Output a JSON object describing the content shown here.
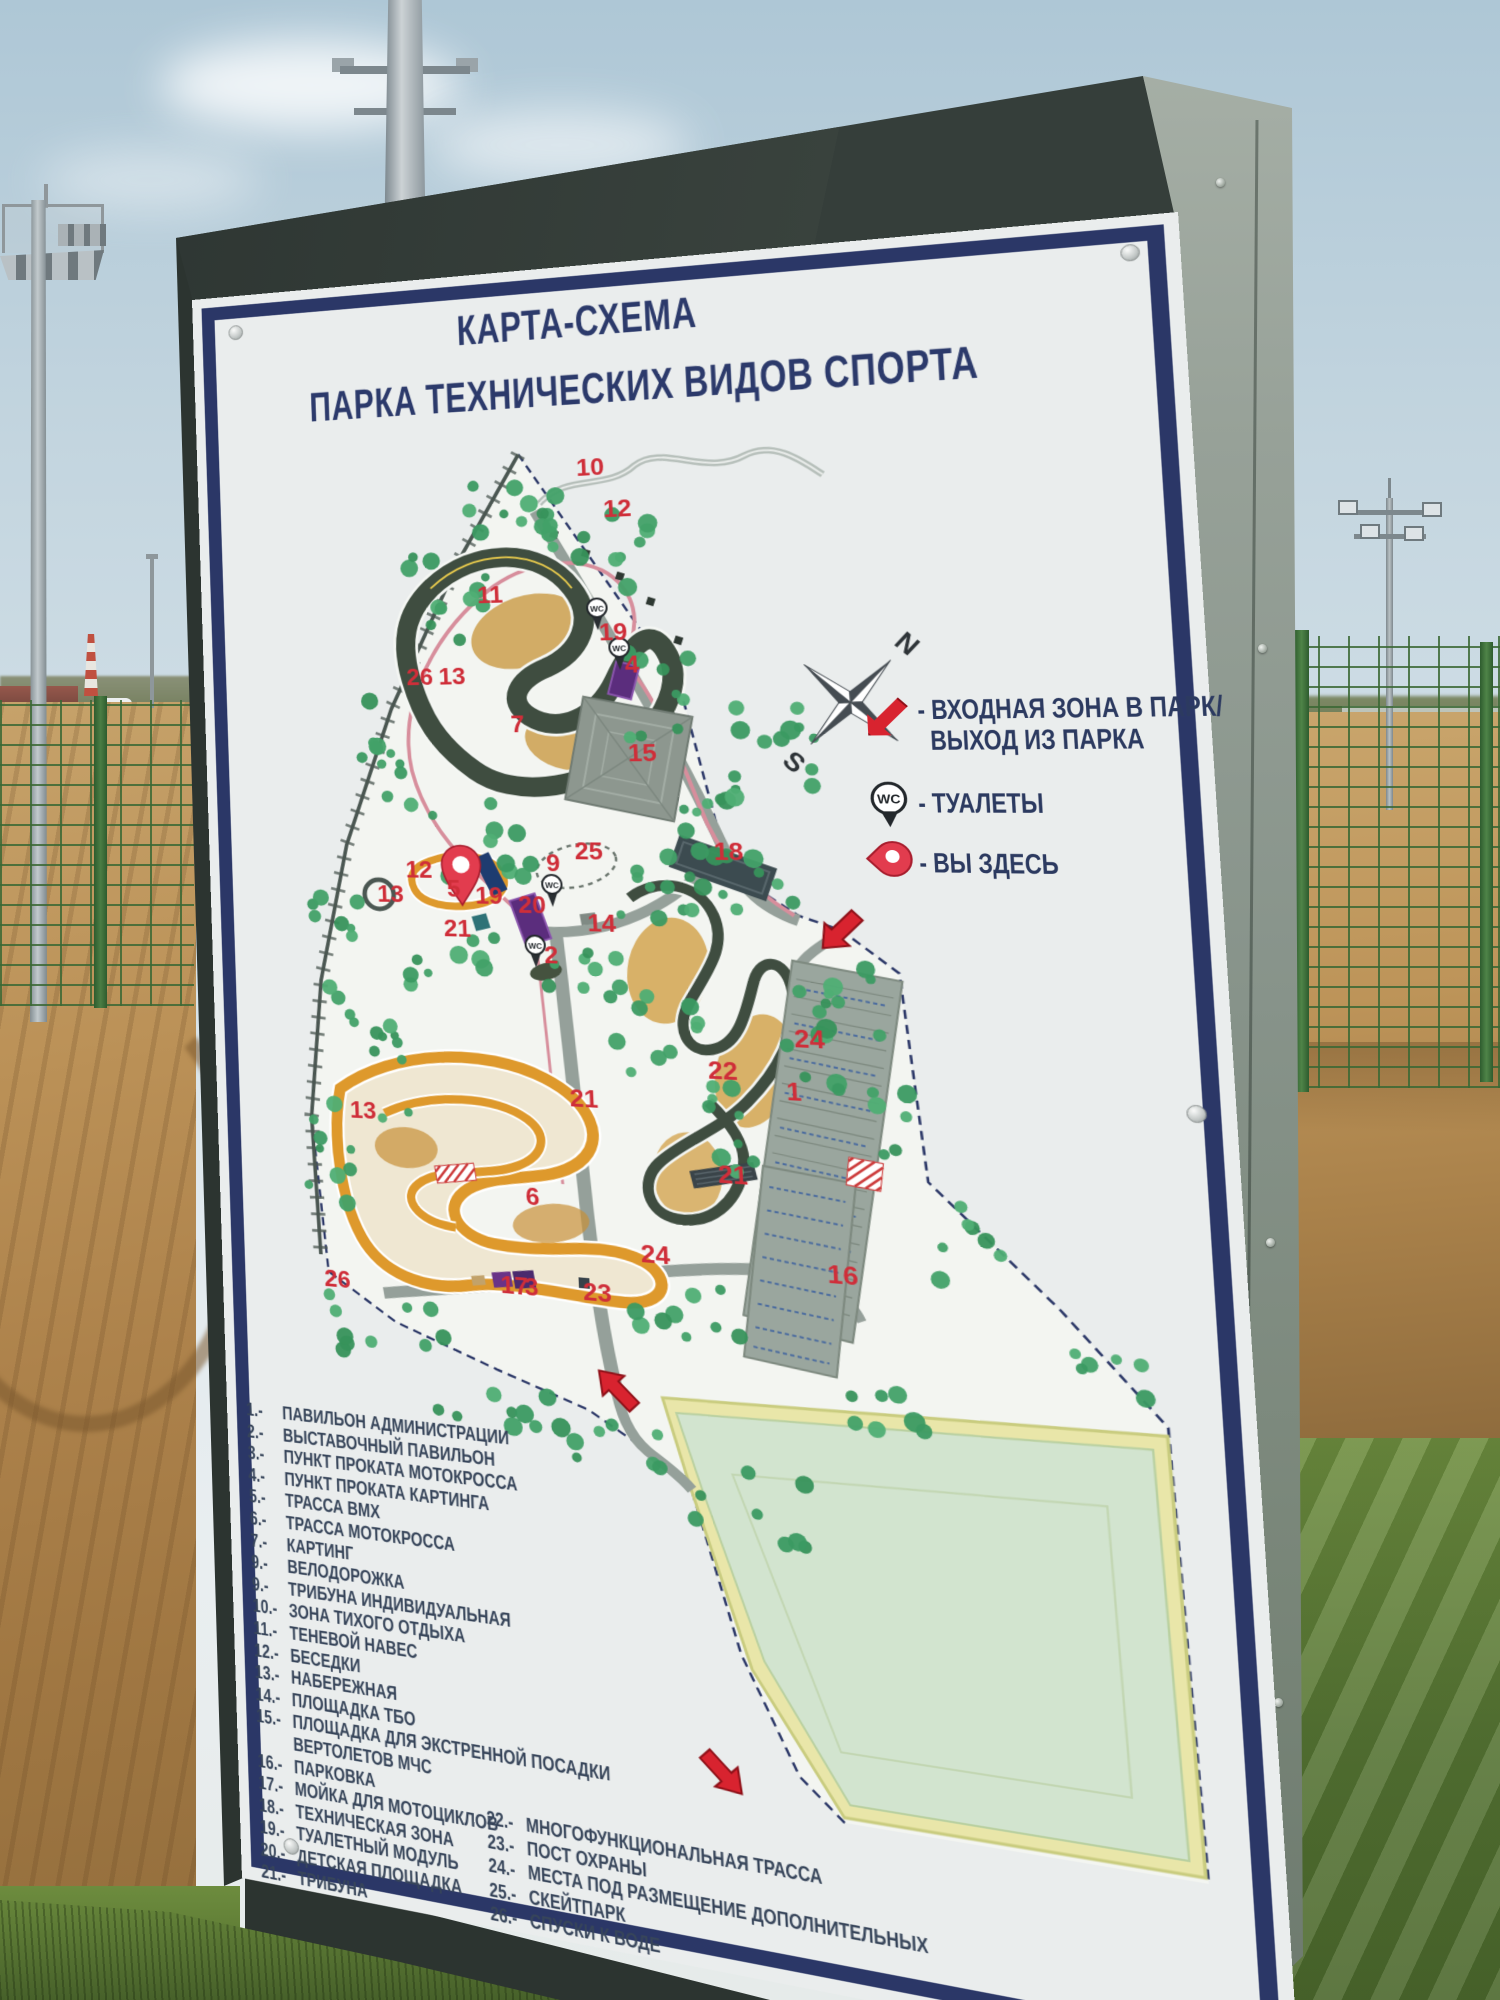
{
  "sign": {
    "title_line1": "КАРТА-СХЕМА",
    "title_line2": "ПАРКА ТЕХНИЧЕСКИХ ВИДОВ СПОРТА",
    "map_legend": {
      "entrance_line1": "- ВХОДНАЯ ЗОНА В ПАРК/",
      "entrance_line2": "ВЫХОД ИЗ ПАРКА",
      "toilets": "- ТУАЛЕТЫ",
      "you_are_here": "- ВЫ ЗДЕСЬ"
    },
    "compass": {
      "north": "N",
      "south": "S"
    },
    "wc_abbr": "WC",
    "list_left": [
      {
        "num": "1.-",
        "text": "ПАВИЛЬОН АДМИНИСТРАЦИИ"
      },
      {
        "num": "2.-",
        "text": "ВЫСТАВОЧНЫЙ ПАВИЛЬОН"
      },
      {
        "num": "3.-",
        "text": "ПУНКТ ПРОКАТА МОТОКРОССА"
      },
      {
        "num": "4.-",
        "text": "ПУНКТ ПРОКАТА КАРТИНГА"
      },
      {
        "num": "5.-",
        "text": "ТРАССА ВМХ"
      },
      {
        "num": "6.-",
        "text": "ТРАССА МОТОКРОССА"
      },
      {
        "num": "7.-",
        "text": "КАРТИНГ"
      },
      {
        "num": "9.-",
        "text": "ВЕЛОДОРОЖКА"
      },
      {
        "num": "9.-",
        "text": "ТРИБУНА ИНДИВИДУАЛЬНАЯ"
      },
      {
        "num": "10.-",
        "text": "ЗОНА ТИХОГО ОТДЫХА"
      },
      {
        "num": "11.-",
        "text": "ТЕНЕВОЙ НАВЕС"
      },
      {
        "num": "12.-",
        "text": "БЕСЕДКИ"
      },
      {
        "num": "13.-",
        "text": "НАБЕРЕЖНАЯ"
      },
      {
        "num": "14.-",
        "text": "ПЛОЩАДКА ТБО"
      },
      {
        "num": "15.-",
        "text": "ПЛОЩАДКА ДЛЯ ЭКСТРЕННОЙ ПОСАДКИ ВЕРТОЛЕТОВ МЧС"
      },
      {
        "num": "16.-",
        "text": "ПАРКОВКА"
      },
      {
        "num": "17.-",
        "text": "МОЙКА ДЛЯ МОТОЦИКЛОВ"
      },
      {
        "num": "18.-",
        "text": "ТЕХНИЧЕСКАЯ ЗОНА"
      },
      {
        "num": "19.-",
        "text": "ТУАЛЕТНЫЙ МОДУЛЬ"
      },
      {
        "num": "20.-",
        "text": "ДЕТСКАЯ ПЛОЩАДКА"
      },
      {
        "num": "21.-",
        "text": "ТРИБУНА"
      }
    ],
    "list_right": [
      {
        "num": "22.-",
        "text": "МНОГОФУНКЦИОНАЛЬНАЯ ТРАССА"
      },
      {
        "num": "23.-",
        "text": "ПОСТ ОХРАНЫ"
      },
      {
        "num": "24.-",
        "text": "МЕСТА ПОД РАЗМЕЩЕНИЕ ДОПОЛНИТЕЛЬНЫХ"
      },
      {
        "num": "25.-",
        "text": "СКЕЙТПАРК"
      },
      {
        "num": "26.-",
        "text": "СПУСКИ К ВОДЕ"
      }
    ],
    "map_numbers": [
      {
        "n": "10",
        "x": 360,
        "y": 34
      },
      {
        "n": "12",
        "x": 386,
        "y": 80
      },
      {
        "n": "11",
        "x": 250,
        "y": 168
      },
      {
        "n": "26",
        "x": 170,
        "y": 256
      },
      {
        "n": "13",
        "x": 205,
        "y": 256
      },
      {
        "n": "7",
        "x": 280,
        "y": 309
      },
      {
        "n": "19",
        "x": 376,
        "y": 212
      },
      {
        "n": "4",
        "x": 401,
        "y": 247
      },
      {
        "n": "15",
        "x": 400,
        "y": 341
      },
      {
        "n": "25",
        "x": 341,
        "y": 445
      },
      {
        "n": "18",
        "x": 481,
        "y": 444
      },
      {
        "n": "9",
        "x": 311,
        "y": 458
      },
      {
        "n": "12",
        "x": 161,
        "y": 467
      },
      {
        "n": "5",
        "x": 205,
        "y": 487
      },
      {
        "n": "13",
        "x": 129,
        "y": 494
      },
      {
        "n": "19",
        "x": 235,
        "y": 494
      },
      {
        "n": "20",
        "x": 280,
        "y": 503
      },
      {
        "n": "14",
        "x": 351,
        "y": 521
      },
      {
        "n": "21",
        "x": 200,
        "y": 530
      },
      {
        "n": "2",
        "x": 305,
        "y": 556
      },
      {
        "n": "24",
        "x": 550,
        "y": 634
      },
      {
        "n": "22",
        "x": 465,
        "y": 670
      },
      {
        "n": "1",
        "x": 540,
        "y": 688
      },
      {
        "n": "21",
        "x": 325,
        "y": 706
      },
      {
        "n": "21",
        "x": 470,
        "y": 776
      },
      {
        "n": "16",
        "x": 570,
        "y": 869
      },
      {
        "n": "13",
        "x": 90,
        "y": 731
      },
      {
        "n": "6",
        "x": 275,
        "y": 812
      },
      {
        "n": "26",
        "x": 55,
        "y": 916
      },
      {
        "n": "24",
        "x": 390,
        "y": 863
      },
      {
        "n": "17",
        "x": 245,
        "y": 907
      },
      {
        "n": "3",
        "x": 270,
        "y": 907
      },
      {
        "n": "23",
        "x": 330,
        "y": 907
      }
    ],
    "colors": {
      "board_navy": "#2b3767",
      "red_label": "#cf2e39",
      "arrow_red": "#d8232f",
      "track_dark": "#3f4d40",
      "track_orange": "#de992c",
      "tree_green": "#42a168",
      "field_pale": "#d2e4cf",
      "pylon_side": "#88948b"
    }
  }
}
